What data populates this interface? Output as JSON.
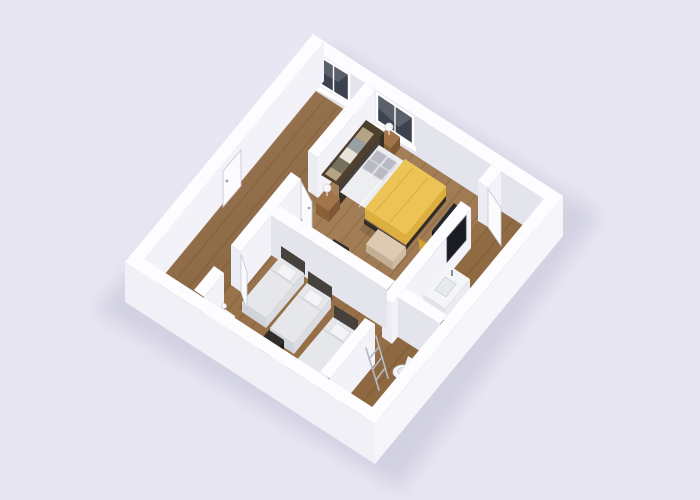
{
  "scene": {
    "type": "3d-floor-plan-render",
    "view": "isometric",
    "rooms": [
      {
        "name": "hallway",
        "items": [
          "entrance-door"
        ]
      },
      {
        "name": "master-bedroom",
        "items": [
          "double-bed-yellow",
          "open-wardrobe",
          "nightstand-far",
          "nightstand-near",
          "table-lamps",
          "tv-panel",
          "bench",
          "stool",
          "window"
        ]
      },
      {
        "name": "triple-bedroom",
        "items": [
          "single-bed-1",
          "single-bed-2",
          "single-bed-3",
          "desk",
          "desk-chair",
          "small-nightstand",
          "door"
        ]
      },
      {
        "name": "bathroom-strip",
        "items": [
          "vanity-sink",
          "vanity-mirror",
          "towel-ladder",
          "toilet",
          "door"
        ]
      }
    ],
    "windows": 2,
    "doors": 4
  },
  "colors": {
    "background": "#e7e6f2",
    "shadow": "#b6b6cd",
    "wallTop": "#fdfdff",
    "faceBright": "#f2f2f8",
    "faceShade": "#e4e4ed",
    "faceCap": "#ececf4",
    "outerSE": "#f6f6fa",
    "outerSW": "#f0f0f6",
    "floor": "#9b7146",
    "plankLine": "rgba(74,44,16,0.22)",
    "windowGlass": "#3c434f",
    "windowFrame": "#ffffff",
    "doorPanel": "#fbfbfe",
    "doorEdge": "#c6c6d6",
    "handle": "#9aa0ad",
    "duvet": "#ecc455",
    "duvetSide": "#ddaf3e",
    "duvetShadow": "#cfa135",
    "sheet": "#edeef2",
    "pillow": "#b9bac3",
    "pillowLight": "#d6d7de",
    "headboard": "#46413c",
    "bedFrame": "#332d28",
    "singleBedding": "#e6e7eb",
    "singleSide": "#dbdde3",
    "singleFoot": "#d2d4db",
    "singlePillow": "#f3f4f6",
    "wood": "#a1744a",
    "woodSideX": "#7e5835",
    "woodSideY": "#8a6038",
    "wardrobeTop": "#4f3f2f",
    "wardrobeSide": "#3a2f23",
    "clothes1": "#b3a483",
    "clothes2": "#99a0a3",
    "clothes3": "#e8e4da",
    "clothes4": "#76705f",
    "dark": "#17171d",
    "darkTop": "#26262e",
    "darkSide": "#101014",
    "beige": "#dccbb2",
    "beigeSideY": "#c3af93",
    "beigeSideX": "#cfbca1",
    "chairDark": "#302d2a",
    "chairDarkSide": "#232120",
    "white": "#f4f5f7",
    "whiteShadeY": "#e2e3e9",
    "whiteShadeX": "#ebecf1",
    "chrome": "#b6bac4",
    "lamp": "#f6f6f8",
    "mirror": "#1b1c23",
    "basin": "#e7e9ee"
  }
}
